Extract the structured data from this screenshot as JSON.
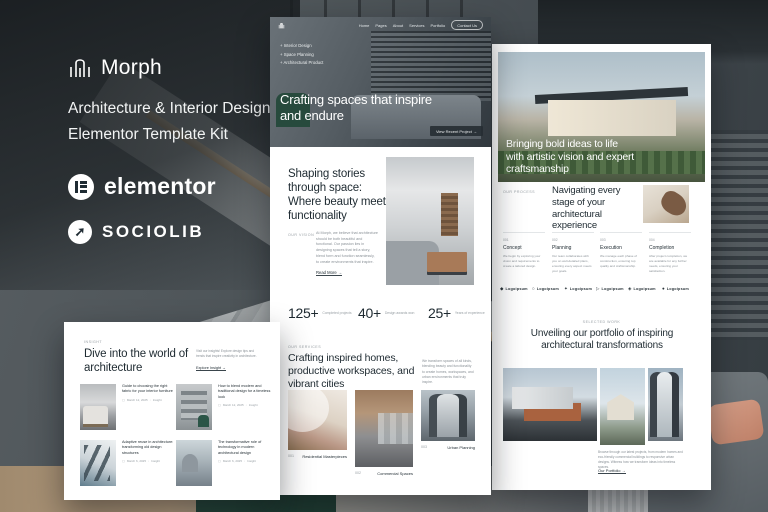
{
  "colors": {
    "heading": "#1e2a31",
    "muted": "#8b9298",
    "label": "#9aa1a6",
    "page": "#ffffff",
    "hero_overlay": "#3c444b",
    "accent_green": "#2c4f41",
    "accent_salmon": "#cf9a84"
  },
  "brand": {
    "name": "Morph",
    "subtitle_line1": "Architecture & Interior Design",
    "subtitle_line2": "Elementor Template Kit",
    "elementor": "elementor",
    "sociolib": "SOCIOLIB"
  },
  "home": {
    "nav": {
      "items": [
        "Home",
        "Pages",
        "About",
        "Services",
        "Portfolio"
      ],
      "cta": "Contact Us"
    },
    "features": [
      "Interior Design",
      "Space Planning",
      "Architectural Product"
    ],
    "hero_heading": "Crafting spaces that inspire and endure",
    "hero_cta": "View Recent Project  →",
    "vision": {
      "label": "Our Vision",
      "heading": "Shaping stories through space: Where beauty meets functionality",
      "body": "At Morph, we believe that architecture should be both beautiful and functional. Our passion lies in designing spaces that tell a story, blend form and function seamlessly, to create environments that inspire.",
      "link": "Read More  →"
    },
    "stats": [
      {
        "value": "125+",
        "label": "Completed projects"
      },
      {
        "value": "40+",
        "label": "Design awards won"
      },
      {
        "value": "25+",
        "label": "Years of experience"
      }
    ],
    "services": {
      "label": "Our Services",
      "heading": "Crafting inspired homes, productive workspaces, and vibrant cities",
      "body": "We transform spaces of all kinds, blending beauty and functionality to create homes, workspaces, and urban environments that truly inspire.",
      "items": [
        {
          "num": "001",
          "name": "Residential Masterpieces"
        },
        {
          "num": "002",
          "name": "Commercial Spaces"
        },
        {
          "num": "003",
          "name": "Urban Planning"
        }
      ]
    }
  },
  "about": {
    "hero_heading": "Bringing bold ideas to life with artistic vision and expert craftsmanship",
    "process": {
      "label": "Our Process",
      "heading": "Navigating every stage of your architectural experience",
      "steps": [
        {
          "num": "001",
          "name": "Concept",
          "body": "We begin by exploring your vision and requirements to create a tailored design."
        },
        {
          "num": "002",
          "name": "Planning",
          "body": "Our team collaborates with you on well-detailed plans, ensuring every aspect meets your goals."
        },
        {
          "num": "003",
          "name": "Execution",
          "body": "We manage each phase of construction, ensuring top quality and craftsmanship."
        },
        {
          "num": "004",
          "name": "Completion",
          "body": "After project completion, we are available for any further needs, ensuring your satisfaction."
        }
      ]
    },
    "logos": [
      {
        "icon": "◆",
        "label": "Logoipsum"
      },
      {
        "icon": "○",
        "label": "Logoipsum"
      },
      {
        "icon": "✦",
        "label": "Logoipsum"
      },
      {
        "icon": "▷",
        "label": "Logoipsum"
      },
      {
        "icon": "◈",
        "label": "Logoipsum"
      },
      {
        "icon": "●",
        "label": "Logoipsum"
      }
    ],
    "portfolio": {
      "label": "Selected Work",
      "heading": "Unveiling our portfolio of inspiring architectural transformations",
      "body": "Browse through our latest projects, from modern homes and eco-friendly commercial buildings to responsive urban designs. Witness how we transform ideas into timeless spaces.",
      "link": "Our Portfolio  →"
    }
  },
  "blog": {
    "label": "Insight",
    "heading": "Dive into the world of architecture",
    "body": "Visit our insights! Explore design tips and trends that inspire creativity in architecture.",
    "link": "Explore Insight  →",
    "posts": [
      {
        "title": "Guide to choosing the right fabric for your interior furniture",
        "date": "March 12, 2025",
        "tag": "Insight"
      },
      {
        "title": "How to blend modern and traditional design for a timeless look",
        "date": "March 12, 2025",
        "tag": "Insight"
      },
      {
        "title": "Adaptive reuse in architecture: transforming old design structures",
        "date": "March 6, 2025",
        "tag": "Insight"
      },
      {
        "title": "The transformative role of technology in modern architectural design",
        "date": "March 6, 2025",
        "tag": "Insight"
      }
    ]
  }
}
